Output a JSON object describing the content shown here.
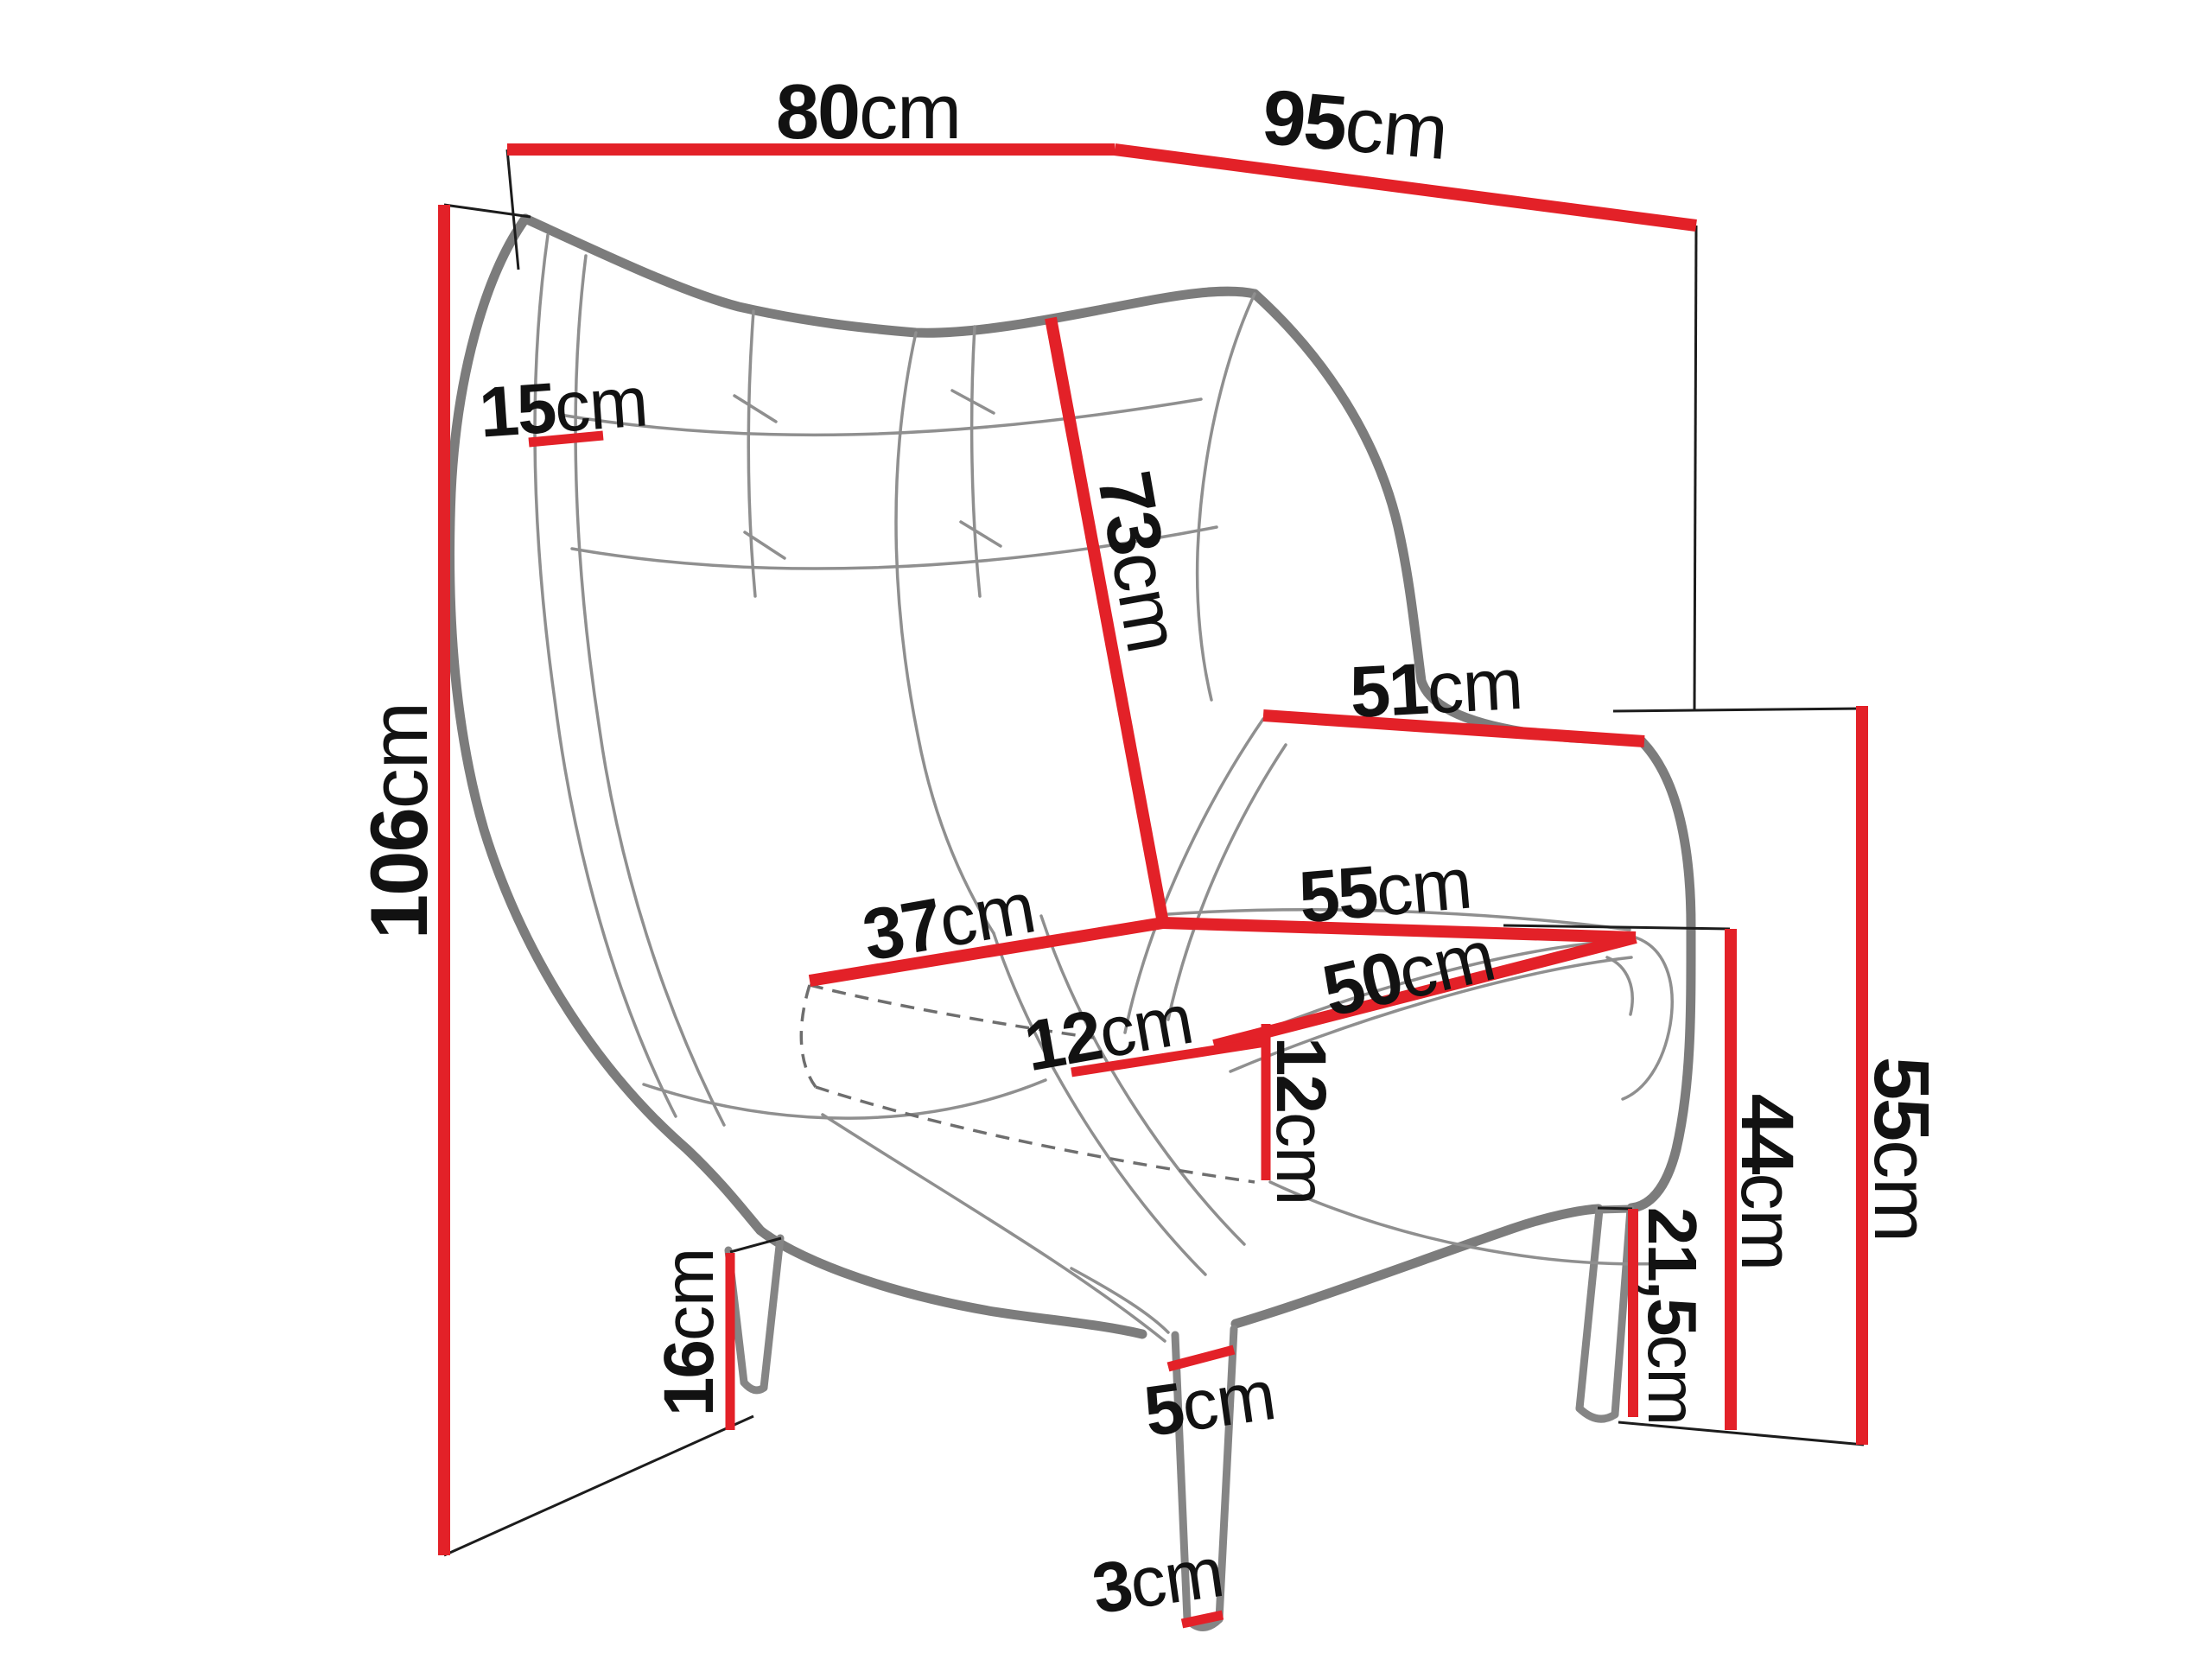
{
  "diagram": {
    "type": "furniture-dimension-diagram",
    "subject": "wingback armchair line sketch with measurement lines",
    "colors": {
      "dimension_line": "#e32128",
      "tick_line": "#1c1c1c",
      "outline": "#7c7c7c",
      "text": "#121212",
      "background": "#ffffff"
    },
    "labels": {
      "l80": {
        "value": "80",
        "unit": "cm"
      },
      "l95": {
        "value": "95",
        "unit": "cm"
      },
      "l106": {
        "value": "106",
        "unit": "cm"
      },
      "l15": {
        "value": "15",
        "unit": "cm"
      },
      "l73": {
        "value": "73",
        "unit": "cm"
      },
      "l51": {
        "value": "51",
        "unit": "cm"
      },
      "l37": {
        "value": "37",
        "unit": "cm"
      },
      "l55_seat": {
        "value": "55",
        "unit": "cm"
      },
      "l50": {
        "value": "50",
        "unit": "cm"
      },
      "l12_seat": {
        "value": "12",
        "unit": "cm"
      },
      "l12_side": {
        "value": "12",
        "unit": "cm"
      },
      "l16": {
        "value": "16",
        "unit": "cm"
      },
      "l5": {
        "value": "5",
        "unit": "cm"
      },
      "l3": {
        "value": "3",
        "unit": "cm"
      },
      "l21_5": {
        "value": "21,5",
        "unit": "cm"
      },
      "l44": {
        "value": "44",
        "unit": "cm"
      },
      "l55_right": {
        "value": "55",
        "unit": "cm"
      }
    }
  }
}
